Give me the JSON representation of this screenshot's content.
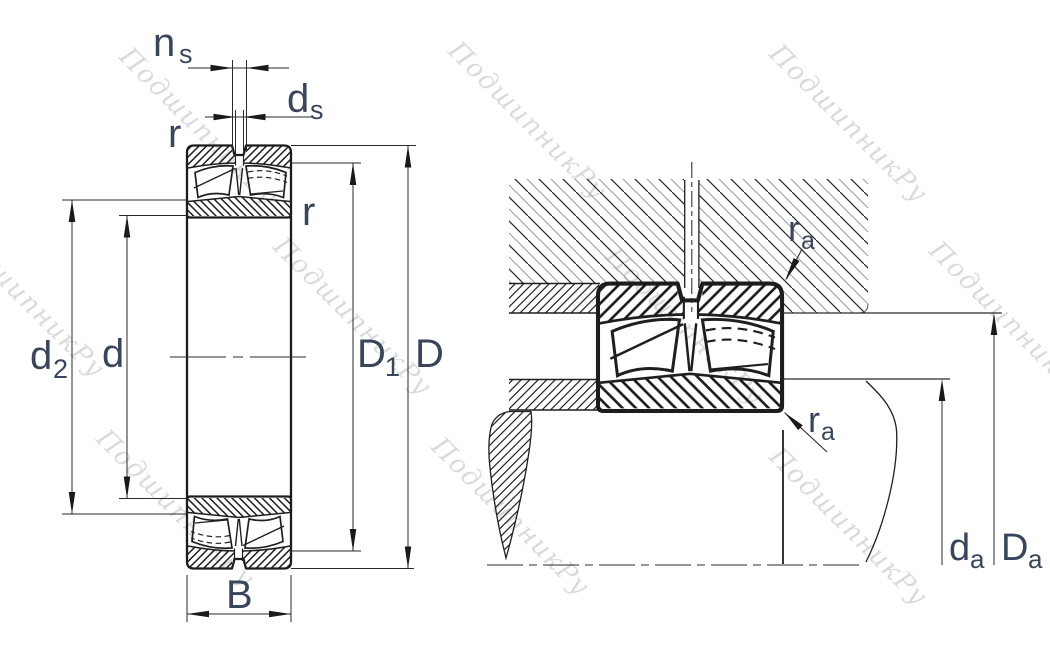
{
  "drawing_type": "bearing-dimension-drawing",
  "left_view": {
    "labels": {
      "ns": {
        "base": "n",
        "sub": "s"
      },
      "ds": {
        "base": "d",
        "sub": "s"
      },
      "r_top": "r",
      "r_side": "r",
      "d2": {
        "base": "d",
        "sub": "2"
      },
      "d": "d",
      "D1": {
        "base": "D",
        "sub": "1"
      },
      "D": "D",
      "B": "B"
    }
  },
  "right_view": {
    "labels": {
      "ra_top": {
        "base": "r",
        "sub": "a"
      },
      "ra_bottom": {
        "base": "r",
        "sub": "a"
      },
      "da": {
        "base": "d",
        "sub": "a"
      },
      "Da": {
        "base": "D",
        "sub": "a"
      }
    }
  },
  "watermark": {
    "text": "ПодшипникРу"
  },
  "colors": {
    "line": "#1f1f1f",
    "dim_line": "#2a2a2a",
    "label": "#39455a",
    "watermark": "#b9bdc3"
  }
}
